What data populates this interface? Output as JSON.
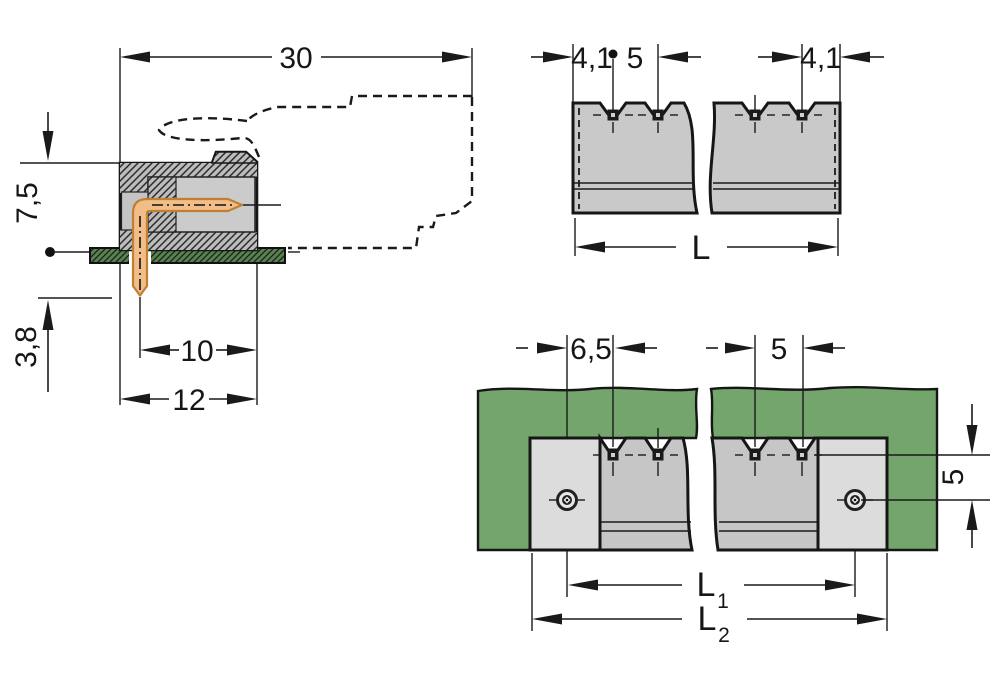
{
  "drawing": {
    "type": "technical-dimension-drawing",
    "subject": "PCB male header connector with angled solder pins",
    "views": {
      "side": {
        "dims": {
          "overall_depth": "30",
          "height_above_board": "7,5",
          "pin_length_below_board": "3,8",
          "front_depth": "10",
          "housing_depth": "12"
        }
      },
      "front": {
        "dims": {
          "edge_to_first_pin": "4,1",
          "pin_pitch": "5",
          "last_pin_to_edge": "4,1",
          "overall_length": "L"
        }
      },
      "board": {
        "dims": {
          "hole_to_first_pin": "6,5",
          "pin_pitch": "5",
          "pin_row_to_hole": "5",
          "hole_spacing_base": "L",
          "hole_spacing_sub": "1",
          "overall_length_base": "L",
          "overall_length_sub": "2"
        }
      }
    },
    "colors": {
      "board_green": "#74a56c",
      "housing_gray": "#c6c6c6",
      "flange_gray": "#dcdcdc",
      "pin_copper": "#f1bd88",
      "line": "#1a1a1a"
    }
  }
}
